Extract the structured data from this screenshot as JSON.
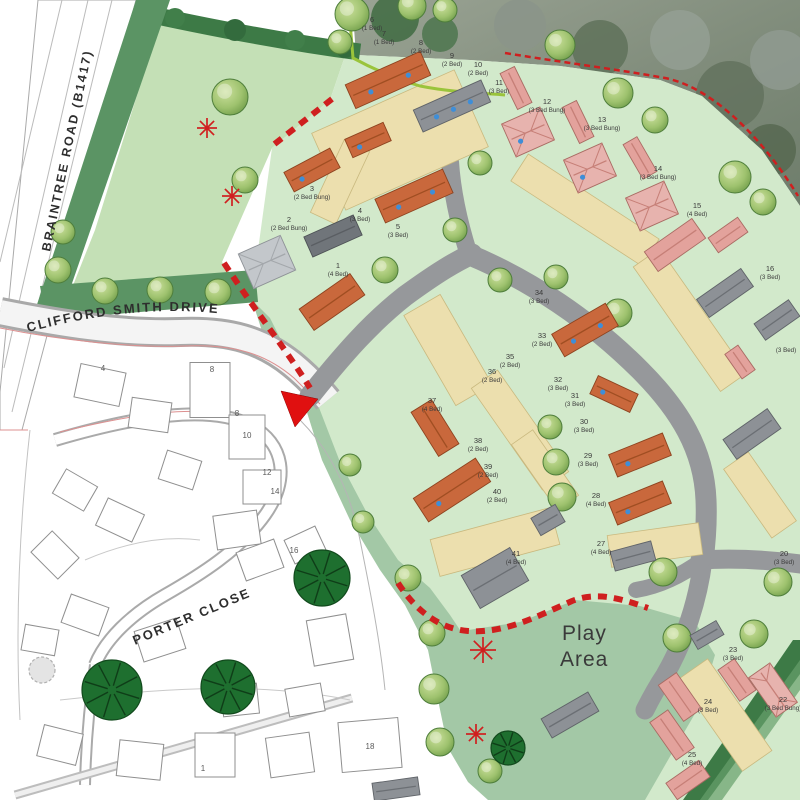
{
  "labels": {
    "braintree": "BRAINTREE ROAD (B1417)",
    "clifford": "CLIFFORD SMITH DRIVE",
    "porter": "PORTER CLOSE",
    "play": [
      "Play",
      "Area"
    ]
  },
  "colors": {
    "road_gray": "#96989b",
    "drive_tan": "#ecdfae",
    "plot_green": "#d2e9cb",
    "field_green": "#c4e0b6",
    "amenity_green": "#a3c8a6",
    "hedge_green": "#3d7a46",
    "boundary_red": "#cf1f1f",
    "roof_orange": "#c9683c",
    "roof_pink": "#e3a29c",
    "roof_gray": "#8d9196",
    "solar_blue": "#3e8ed8",
    "tree_green": "#8fb561",
    "dark_tree_green": "#1e6f2f"
  },
  "plots": [
    {
      "n": "6",
      "t": "(1 Bed)",
      "x": 372,
      "y": 22
    },
    {
      "n": "7",
      "t": "(1 Bed)",
      "x": 384,
      "y": 36
    },
    {
      "n": "8",
      "t": "(2 Bed)",
      "x": 421,
      "y": 45
    },
    {
      "n": "9",
      "t": "(2 Bed)",
      "x": 452,
      "y": 58
    },
    {
      "n": "10",
      "t": "(2 Bed)",
      "x": 478,
      "y": 67
    },
    {
      "n": "11",
      "t": "(3 Bed)",
      "x": 499,
      "y": 85
    },
    {
      "n": "12",
      "t": "(3 Bed Bung)",
      "x": 547,
      "y": 104
    },
    {
      "n": "13",
      "t": "(3 Bed Bung)",
      "x": 602,
      "y": 122
    },
    {
      "n": "14",
      "t": "(3 Bed Bung)",
      "x": 658,
      "y": 171
    },
    {
      "n": "15",
      "t": "(4 Bed)",
      "x": 697,
      "y": 208
    },
    {
      "n": "16",
      "t": "(3 Bed)",
      "x": 770,
      "y": 271
    },
    {
      "n": "",
      "t": "(3 Bed)",
      "x": 786,
      "y": 344
    },
    {
      "n": "3",
      "t": "(2 Bed Bung)",
      "x": 312,
      "y": 191
    },
    {
      "n": "2",
      "t": "(2 Bed Bung)",
      "x": 289,
      "y": 222
    },
    {
      "n": "4",
      "t": "(3 Bed)",
      "x": 360,
      "y": 213
    },
    {
      "n": "5",
      "t": "(3 Bed)",
      "x": 398,
      "y": 229
    },
    {
      "n": "1",
      "t": "(4 Bed)",
      "x": 338,
      "y": 268
    },
    {
      "n": "34",
      "t": "(3 Bed)",
      "x": 539,
      "y": 295
    },
    {
      "n": "33",
      "t": "(2 Bed)",
      "x": 542,
      "y": 338
    },
    {
      "n": "35",
      "t": "(2 Bed)",
      "x": 510,
      "y": 359
    },
    {
      "n": "36",
      "t": "(2 Bed)",
      "x": 492,
      "y": 374
    },
    {
      "n": "32",
      "t": "(3 Bed)",
      "x": 558,
      "y": 382
    },
    {
      "n": "31",
      "t": "(3 Bed)",
      "x": 575,
      "y": 398
    },
    {
      "n": "30",
      "t": "(3 Bed)",
      "x": 584,
      "y": 424
    },
    {
      "n": "29",
      "t": "(3 Bed)",
      "x": 588,
      "y": 458
    },
    {
      "n": "28",
      "t": "(4 Bed)",
      "x": 596,
      "y": 498
    },
    {
      "n": "37",
      "t": "(4 Bed)",
      "x": 432,
      "y": 403
    },
    {
      "n": "38",
      "t": "(2 Bed)",
      "x": 478,
      "y": 443
    },
    {
      "n": "39",
      "t": "(2 Bed)",
      "x": 488,
      "y": 469
    },
    {
      "n": "40",
      "t": "(2 Bed)",
      "x": 497,
      "y": 494
    },
    {
      "n": "41",
      "t": "(4 Bed)",
      "x": 516,
      "y": 556
    },
    {
      "n": "27",
      "t": "(4 Bed)",
      "x": 601,
      "y": 546
    },
    {
      "n": "20",
      "t": "(3 Bed)",
      "x": 784,
      "y": 556
    },
    {
      "n": "23",
      "t": "(3 Bed)",
      "x": 733,
      "y": 652
    },
    {
      "n": "24",
      "t": "(3 Bed)",
      "x": 708,
      "y": 704
    },
    {
      "n": "22",
      "t": "(3 Bed Bung)",
      "x": 783,
      "y": 702
    },
    {
      "n": "25",
      "t": "(4 Bed)",
      "x": 692,
      "y": 757
    }
  ],
  "existing_numbers": [
    {
      "n": "4",
      "x": 103,
      "y": 371
    },
    {
      "n": "8",
      "x": 212,
      "y": 372
    },
    {
      "n": "8",
      "x": 237,
      "y": 416
    },
    {
      "n": "10",
      "x": 247,
      "y": 438
    },
    {
      "n": "12",
      "x": 267,
      "y": 475
    },
    {
      "n": "14",
      "x": 275,
      "y": 494
    },
    {
      "n": "16",
      "x": 294,
      "y": 553
    },
    {
      "n": "18",
      "x": 370,
      "y": 749
    },
    {
      "n": "1",
      "x": 203,
      "y": 771
    }
  ],
  "houses": [
    {
      "x": 388,
      "y": 80,
      "w": 82,
      "h": 26,
      "r": -24,
      "c": "orange",
      "d": 2
    },
    {
      "x": 452,
      "y": 106,
      "w": 74,
      "h": 24,
      "r": -24,
      "c": "gray",
      "d": 3
    },
    {
      "x": 368,
      "y": 140,
      "w": 42,
      "h": 20,
      "r": -24,
      "c": "orange",
      "d": 1
    },
    {
      "x": 312,
      "y": 170,
      "w": 52,
      "h": 22,
      "r": -28,
      "c": "orange",
      "d": 1
    },
    {
      "x": 414,
      "y": 196,
      "w": 74,
      "h": 26,
      "r": -24,
      "c": "orange",
      "d": 2
    },
    {
      "x": 333,
      "y": 236,
      "w": 54,
      "h": 22,
      "r": -24,
      "c": "darkgray",
      "d": 0
    },
    {
      "x": 267,
      "y": 262,
      "w": 46,
      "h": 38,
      "r": -24,
      "c": "lightgray",
      "d": 0
    },
    {
      "x": 332,
      "y": 302,
      "w": 62,
      "h": 26,
      "r": -35,
      "c": "orange",
      "d": 0
    },
    {
      "x": 516,
      "y": 88,
      "w": 40,
      "h": 16,
      "r": 64,
      "c": "pink",
      "d": 0
    },
    {
      "x": 528,
      "y": 132,
      "w": 42,
      "h": 36,
      "r": -24,
      "c": "pinkhip",
      "d": 1
    },
    {
      "x": 578,
      "y": 122,
      "w": 40,
      "h": 16,
      "r": 64,
      "c": "pink",
      "d": 0
    },
    {
      "x": 590,
      "y": 168,
      "w": 42,
      "h": 36,
      "r": -24,
      "c": "pinkhip",
      "d": 1
    },
    {
      "x": 640,
      "y": 158,
      "w": 40,
      "h": 16,
      "r": 60,
      "c": "pink",
      "d": 0
    },
    {
      "x": 652,
      "y": 206,
      "w": 42,
      "h": 36,
      "r": -24,
      "c": "pinkhip",
      "d": 0
    },
    {
      "x": 675,
      "y": 245,
      "w": 58,
      "h": 24,
      "r": -35,
      "c": "pink",
      "d": 0
    },
    {
      "x": 728,
      "y": 235,
      "w": 36,
      "h": 18,
      "r": -35,
      "c": "pink",
      "d": 0
    },
    {
      "x": 725,
      "y": 293,
      "w": 54,
      "h": 22,
      "r": -35,
      "c": "gray",
      "d": 0
    },
    {
      "x": 777,
      "y": 320,
      "w": 42,
      "h": 20,
      "r": -35,
      "c": "gray",
      "d": 0
    },
    {
      "x": 740,
      "y": 362,
      "w": 30,
      "h": 16,
      "r": 55,
      "c": "pink",
      "d": 0
    },
    {
      "x": 752,
      "y": 434,
      "w": 54,
      "h": 24,
      "r": -35,
      "c": "gray",
      "d": 0
    },
    {
      "x": 585,
      "y": 330,
      "w": 62,
      "h": 26,
      "r": -30,
      "c": "orange",
      "d": 2
    },
    {
      "x": 435,
      "y": 428,
      "w": 52,
      "h": 24,
      "r": 58,
      "c": "orange",
      "d": 0
    },
    {
      "x": 452,
      "y": 490,
      "w": 74,
      "h": 28,
      "r": -33,
      "c": "orange",
      "d": 1
    },
    {
      "x": 614,
      "y": 394,
      "w": 44,
      "h": 20,
      "r": 25,
      "c": "orange",
      "d": 1
    },
    {
      "x": 640,
      "y": 455,
      "w": 58,
      "h": 24,
      "r": -22,
      "c": "orange",
      "d": 1
    },
    {
      "x": 640,
      "y": 503,
      "w": 58,
      "h": 24,
      "r": -22,
      "c": "orange",
      "d": 1
    },
    {
      "x": 548,
      "y": 520,
      "w": 28,
      "h": 20,
      "r": -30,
      "c": "gray",
      "d": 0
    },
    {
      "x": 495,
      "y": 578,
      "w": 56,
      "h": 38,
      "r": -30,
      "c": "gray",
      "d": 0
    },
    {
      "x": 633,
      "y": 556,
      "w": 42,
      "h": 20,
      "r": -15,
      "c": "gray",
      "d": 0
    },
    {
      "x": 707,
      "y": 635,
      "w": 30,
      "h": 16,
      "r": -30,
      "c": "gray",
      "d": 0
    },
    {
      "x": 570,
      "y": 715,
      "w": 54,
      "h": 22,
      "r": -30,
      "c": "gray",
      "d": 0
    },
    {
      "x": 680,
      "y": 697,
      "w": 44,
      "h": 22,
      "r": 55,
      "c": "pink",
      "d": 0
    },
    {
      "x": 737,
      "y": 680,
      "w": 38,
      "h": 20,
      "r": 55,
      "c": "pink",
      "d": 0
    },
    {
      "x": 773,
      "y": 690,
      "w": 48,
      "h": 26,
      "r": 55,
      "c": "pinkhip",
      "d": 0
    },
    {
      "x": 672,
      "y": 735,
      "w": 46,
      "h": 22,
      "r": 55,
      "c": "pink",
      "d": 0
    },
    {
      "x": 688,
      "y": 780,
      "w": 40,
      "h": 20,
      "r": -35,
      "c": "pink",
      "d": 0
    },
    {
      "x": 396,
      "y": 789,
      "w": 46,
      "h": 18,
      "r": -8,
      "c": "gray",
      "d": 0
    }
  ],
  "trees": {
    "light": [
      [
        58,
        270,
        13
      ],
      [
        105,
        291,
        13
      ],
      [
        160,
        290,
        13
      ],
      [
        218,
        292,
        13
      ],
      [
        63,
        232,
        12
      ],
      [
        245,
        180,
        13
      ],
      [
        230,
        97,
        18
      ],
      [
        340,
        42,
        12
      ],
      [
        352,
        14,
        17
      ],
      [
        412,
        6,
        14
      ],
      [
        445,
        10,
        12
      ],
      [
        560,
        45,
        15
      ],
      [
        618,
        93,
        15
      ],
      [
        655,
        120,
        13
      ],
      [
        735,
        177,
        16
      ],
      [
        763,
        202,
        13
      ],
      [
        385,
        270,
        13
      ],
      [
        455,
        230,
        12
      ],
      [
        480,
        163,
        12
      ],
      [
        500,
        280,
        12
      ],
      [
        556,
        277,
        12
      ],
      [
        618,
        313,
        14
      ],
      [
        550,
        427,
        12
      ],
      [
        556,
        462,
        13
      ],
      [
        562,
        497,
        14
      ],
      [
        350,
        465,
        11
      ],
      [
        363,
        522,
        11
      ],
      [
        408,
        578,
        13
      ],
      [
        432,
        633,
        13
      ],
      [
        434,
        689,
        15
      ],
      [
        440,
        742,
        14
      ],
      [
        490,
        771,
        12
      ],
      [
        663,
        572,
        14
      ],
      [
        677,
        638,
        14
      ],
      [
        754,
        634,
        14
      ],
      [
        778,
        582,
        14
      ]
    ],
    "dark": [
      [
        322,
        578,
        28
      ],
      [
        112,
        690,
        30
      ],
      [
        228,
        687,
        27
      ],
      [
        508,
        748,
        17
      ]
    ],
    "scribble": [
      [
        42,
        670,
        13
      ]
    ]
  },
  "stars": [
    [
      207,
      128,
      10
    ],
    [
      232,
      196,
      10
    ],
    [
      483,
      650,
      13
    ],
    [
      476,
      734,
      10
    ]
  ]
}
